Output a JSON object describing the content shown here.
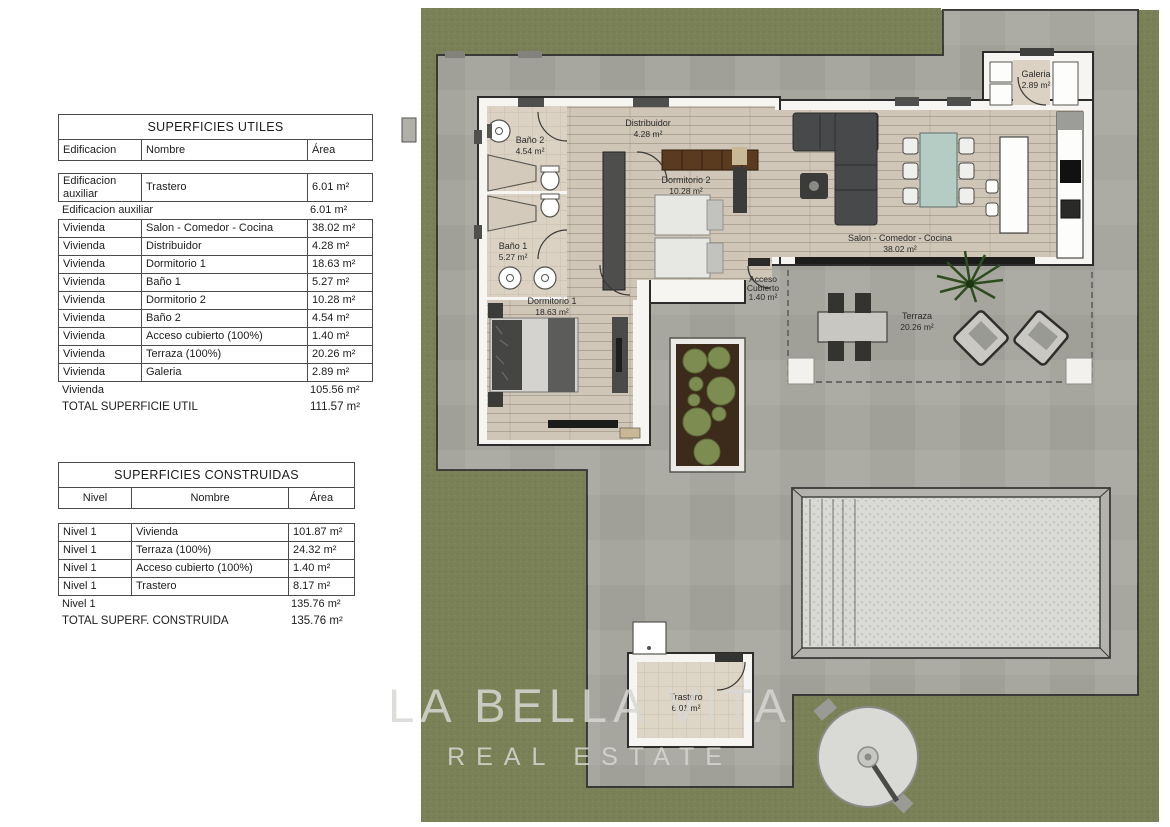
{
  "tables": {
    "utiles": {
      "title": "SUPERFICIES UTILES",
      "columns": [
        "Edificacion",
        "Nombre",
        "Área"
      ],
      "group1_rows": [
        [
          "Edificacion auxiliar",
          "Trastero",
          "6.01 m²"
        ]
      ],
      "group1_subtotal": {
        "label": "Edificacion auxiliar",
        "value": "6.01 m²"
      },
      "group2_rows": [
        [
          "Vivienda",
          "Salon - Comedor - Cocina",
          "38.02 m²"
        ],
        [
          "Vivienda",
          "Distribuidor",
          "4.28 m²"
        ],
        [
          "Vivienda",
          "Dormitorio 1",
          "18.63 m²"
        ],
        [
          "Vivienda",
          "Baño 1",
          "5.27 m²"
        ],
        [
          "Vivienda",
          "Dormitorio 2",
          "10.28 m²"
        ],
        [
          "Vivienda",
          "Baño 2",
          "4.54 m²"
        ],
        [
          "Vivienda",
          "Acceso cubierto (100%)",
          "1.40 m²"
        ],
        [
          "Vivienda",
          "Terraza (100%)",
          "20.26 m²"
        ],
        [
          "Vivienda",
          "Galeria",
          "2.89 m²"
        ]
      ],
      "group2_subtotal": {
        "label": "Vivienda",
        "value": "105.56 m²"
      },
      "total": {
        "label": "TOTAL SUPERFICIE UTIL",
        "value": "111.57 m²"
      }
    },
    "construidas": {
      "title": "SUPERFICIES CONSTRUIDAS",
      "columns": [
        "Nivel",
        "Nombre",
        "Área"
      ],
      "rows": [
        [
          "Nivel 1",
          "Vivienda",
          "101.87 m²"
        ],
        [
          "Nivel 1",
          "Terraza (100%)",
          "24.32 m²"
        ],
        [
          "Nivel 1",
          "Acceso cubierto (100%)",
          "1.40 m²"
        ],
        [
          "Nivel 1",
          "Trastero",
          "8.17 m²"
        ]
      ],
      "subtotal": {
        "label": "Nivel 1",
        "value": "135.76 m²"
      },
      "total": {
        "label": "TOTAL SUPERF. CONSTRUIDA",
        "value": "135.76 m²"
      }
    }
  },
  "floorplan": {
    "rooms": {
      "distribuidor": {
        "name": "Distribuidor",
        "area": "4.28 m²"
      },
      "bano2": {
        "name": "Baño 2",
        "area": "4.54 m²"
      },
      "bano1": {
        "name": "Baño 1",
        "area": "5.27 m²"
      },
      "dorm2": {
        "name": "Dormitorio 2",
        "area": "10.28 m²"
      },
      "dorm1": {
        "name": "Dormitorio 1",
        "area": "18.63 m²"
      },
      "salon": {
        "name": "Salon - Comedor - Cocina",
        "area": "38.02 m²"
      },
      "galeria": {
        "name": "Galeria",
        "area": "2.89 m²"
      },
      "acceso": {
        "line1": "Acceso",
        "line2": "Cubierto",
        "area": "1.40 m²"
      },
      "terraza": {
        "name": "Terraza",
        "area": "20.26 m²"
      },
      "trastero": {
        "name": "Trastero",
        "area": "6.01 m²"
      }
    },
    "colors": {
      "grass": "#7b8157",
      "paving": "#a8a79f",
      "pool_water": "#d9d9d5",
      "wood_floor": "#cfc6b8",
      "tile_floor": "#dbd2c4",
      "wall_outline": "#2c2c2c"
    }
  },
  "watermark": {
    "line1": "LA BELLA VITA",
    "line2": "REAL ESTATE"
  }
}
